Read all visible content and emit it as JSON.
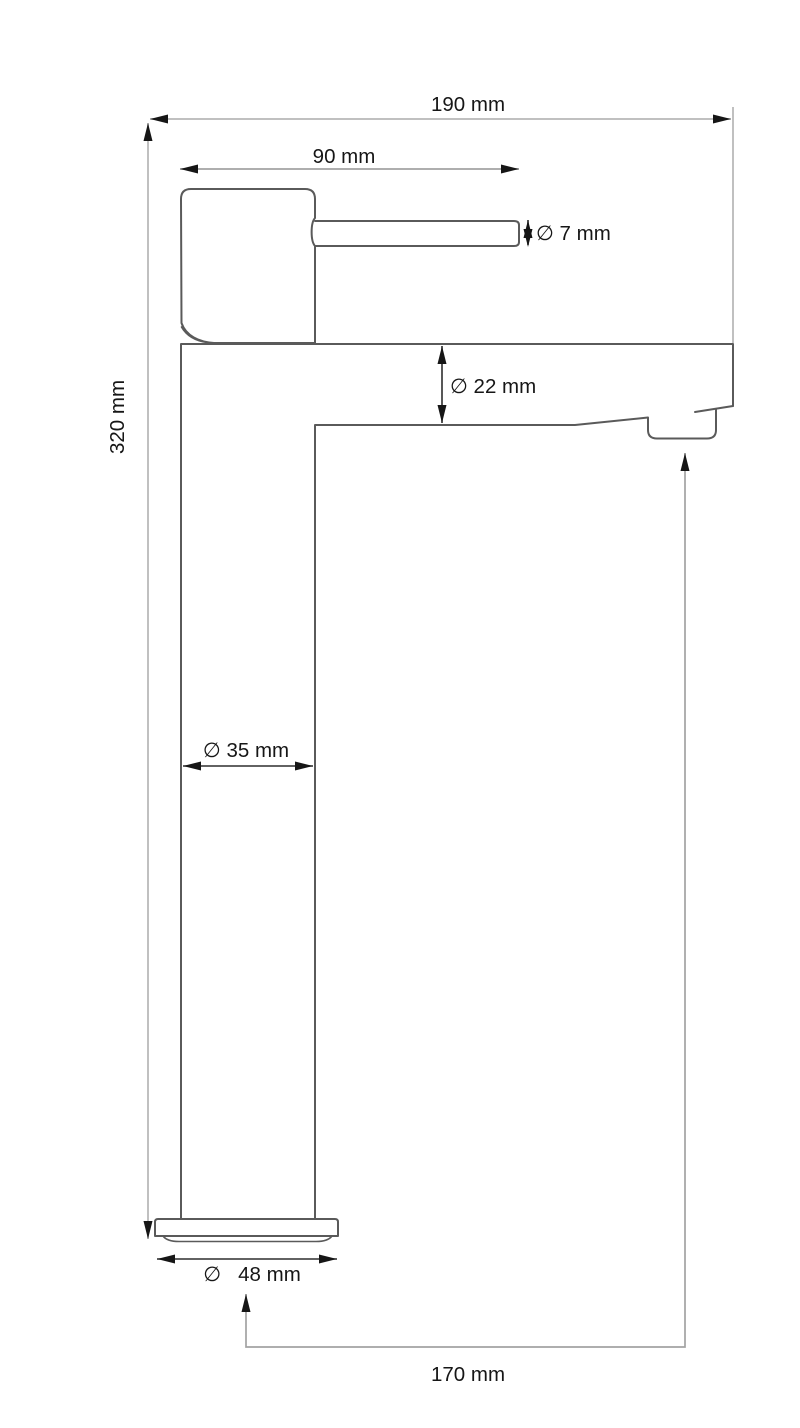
{
  "drawing": {
    "type": "technical dimension drawing",
    "subject": "tall single-lever basin mixer tap, side view",
    "unit": "mm",
    "dimensions": [
      {
        "id": "total-width",
        "label": "190 mm",
        "value": 190,
        "unit": "mm",
        "diameter": false
      },
      {
        "id": "handle-length",
        "label": "90 mm",
        "value": 90,
        "unit": "mm",
        "diameter": false
      },
      {
        "id": "lever-diameter",
        "label": "∅ 7 mm",
        "value": 7,
        "unit": "mm",
        "diameter": true
      },
      {
        "id": "spout-diameter",
        "label": "∅ 22 mm",
        "value": 22,
        "unit": "mm",
        "diameter": true
      },
      {
        "id": "total-height",
        "label": "320 mm",
        "value": 320,
        "unit": "mm",
        "diameter": false
      },
      {
        "id": "body-diameter",
        "label": "∅ 35 mm",
        "value": 35,
        "unit": "mm",
        "diameter": true
      },
      {
        "id": "base-diameter",
        "label": "∅   48 mm",
        "value": 48,
        "unit": "mm",
        "diameter": true
      },
      {
        "id": "spout-offset",
        "label": "170 mm",
        "value": 170,
        "unit": "mm",
        "diameter": false
      }
    ]
  },
  "colors": {
    "outline": "#5a5a5a",
    "ink": "#161616",
    "dim_light": "#c0c0c0",
    "dim_gray": "#a3a3a3",
    "dim_dark": "#2e2e2e",
    "background": "#ffffff"
  }
}
